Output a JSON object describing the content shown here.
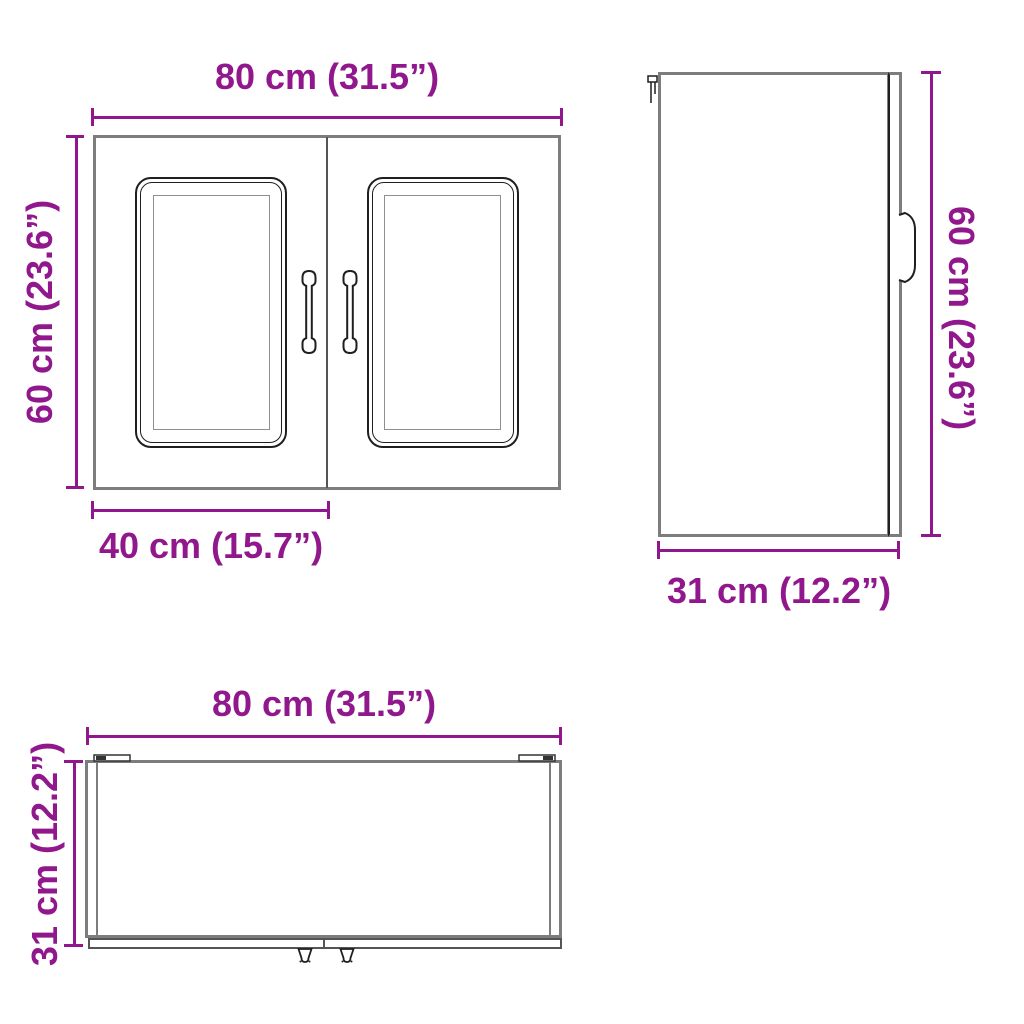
{
  "colors": {
    "dimension_text": "#90188C",
    "outline_gray": "#7d7d7d",
    "detail_dark": "#1f1f1f"
  },
  "front_view": {
    "width_label": "80 cm (31.5”)",
    "height_label": "60 cm (23.6”)",
    "door_width_label": "40 cm (15.7”)"
  },
  "side_view": {
    "height_label": "60 cm (23.6”)",
    "depth_label": "31 cm (12.2”)"
  },
  "top_view": {
    "width_label": "80 cm (31.5”)",
    "depth_label": "31 cm (12.2”)"
  }
}
